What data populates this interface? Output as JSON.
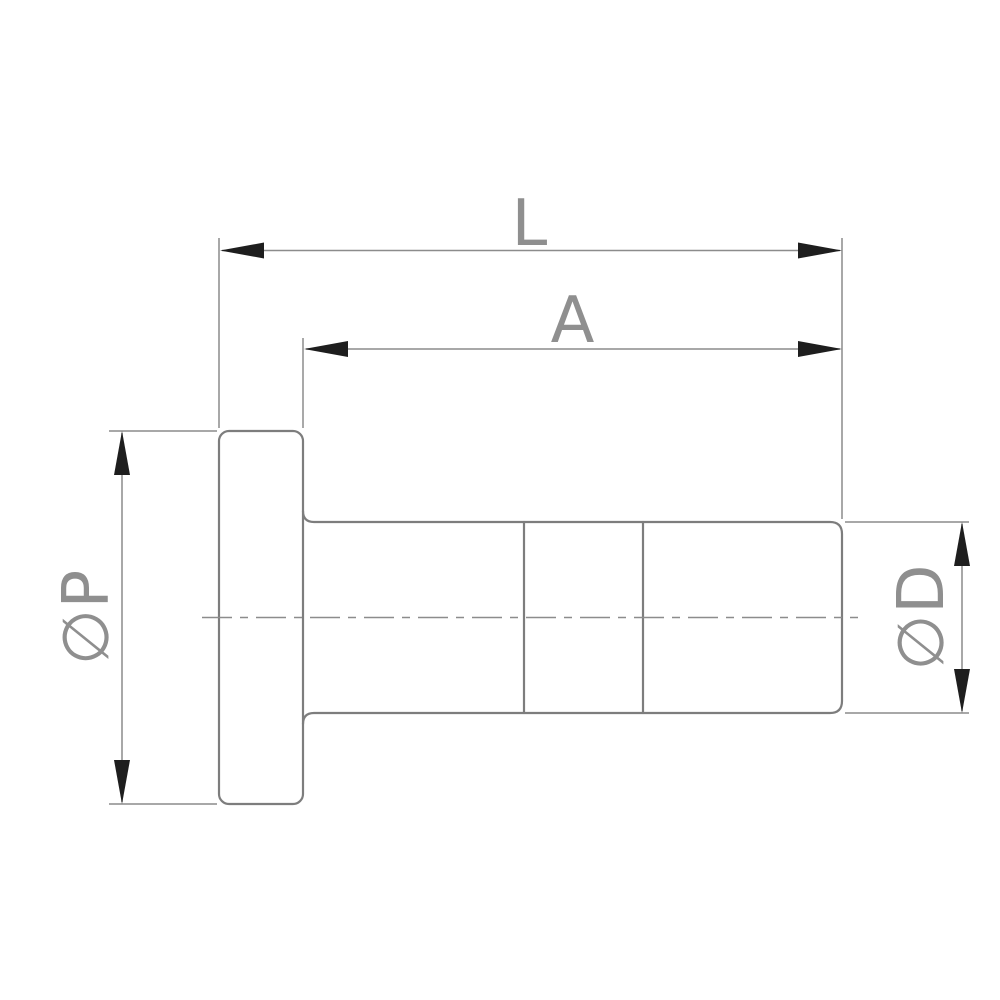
{
  "drawing": {
    "type": "technical-dimension-drawing",
    "part": "flanged-plug-fitting-side-view",
    "labels": {
      "overall_length": "L",
      "body_length": "A",
      "flange_diameter": "∅P",
      "body_diameter": "∅D"
    },
    "colors": {
      "background": "#ffffff",
      "outline": "#7d7d7d",
      "dimension_line": "#8c8c8c",
      "arrow": "#1e1e1e",
      "label_text": "#8f8f8f"
    }
  }
}
